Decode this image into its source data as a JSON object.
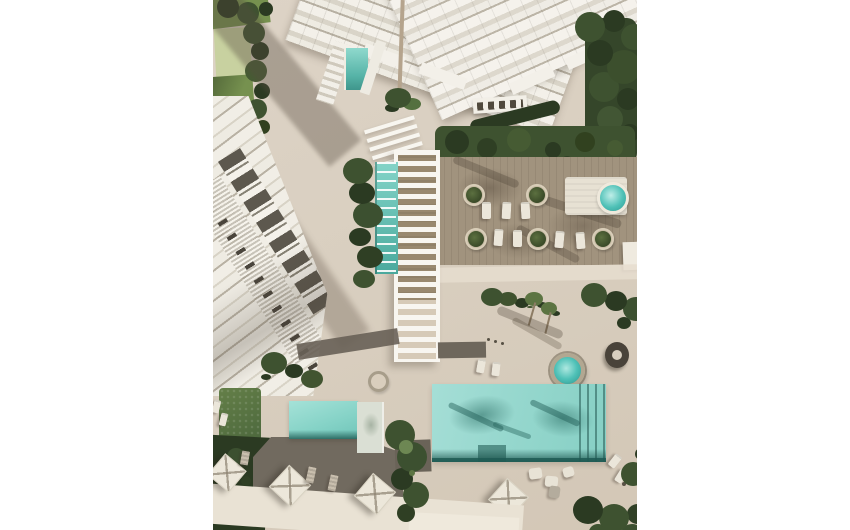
{
  "meta": {
    "type": "architectural-aerial-render",
    "description": "Top-down 3D architectural rendering of a beachfront residential complex: white apartment tower, diagonal row of townhouses, pergola walkway, lap pool, wooden sun deck with palm planters, two round spas, a large main pool and a smaller pool with umbrellas and sun loungers.",
    "canvas": {
      "width": 850,
      "height": 530
    },
    "content_area": {
      "left": 213,
      "width": 424,
      "height": 530
    }
  },
  "palette": {
    "ground": "#d9cfc0",
    "ground-light": "#e6ddcf",
    "ground-dark": "#cfc3b1",
    "path": "#e9e2d4",
    "tower-white": "#f3f0e9",
    "tower-stripe": "#d9d4c8",
    "tower-line": "#b7b0a2",
    "bld-white": "#f1eee6",
    "bld-dark": "#5d584e",
    "wood": "#a1937e",
    "deck-gray": "#716a5f",
    "walkway": "#6e675c",
    "pergola-white": "#f8f6f0",
    "pergola-wood": "#99896f",
    "pool-light": "#a5ded6",
    "pool-mid": "#86cfc4",
    "pool-dark": "#1f5a54",
    "pool-shadow": "#26685f",
    "lap-pool": "#83d4c8",
    "spa": "#4fc1b7",
    "lawn": "#76914f",
    "lawn-pale": "#c8d1a0",
    "tree": "#3e5230",
    "tree-dark": "#2b3a22",
    "tree-light": "#5c7442",
    "hedge": "#55713d",
    "umbrella": "#ece7da",
    "lounger": "#ebe6da",
    "tan": "#c9bfae",
    "shadow": "rgba(88,76,62,0.38)"
  },
  "scene": {
    "elements": [
      {
        "name": "white-margin-left",
        "desc": "blank white border left of render"
      },
      {
        "name": "white-margin-right",
        "desc": "blank white border right of render"
      },
      {
        "name": "tower-building",
        "desc": "white high-rise with stepped balconies, viewed from above at corner"
      },
      {
        "name": "tower-lap-pool",
        "desc": "small teal pool embedded in tower terraces"
      },
      {
        "name": "townhouse-row",
        "desc": "diagonal row of white townhouses with dark balcony recesses"
      },
      {
        "name": "pergola-walkway",
        "desc": "white slatted pergola over wooden boardwalk"
      },
      {
        "name": "lane-pool",
        "desc": "narrow lap pool with white lane steps beside pergola"
      },
      {
        "name": "wood-deck",
        "desc": "timber sun deck with circular palm planters and loungers"
      },
      {
        "name": "round-spa-upper",
        "desc": "round teal spa on white platform at deck right"
      },
      {
        "name": "round-spa-lower",
        "desc": "round teal spa near main pool"
      },
      {
        "name": "main-pool",
        "desc": "large teal pool with palm shadows and lane markers"
      },
      {
        "name": "small-pool",
        "desc": "smaller teal pool with gray deck, umbrellas and loungers"
      },
      {
        "name": "gardens",
        "desc": "dark green trees, hedges and lawns around the plaza"
      },
      {
        "name": "ground-plaza",
        "desc": "warm beige paved plaza with long diagonal shadows"
      }
    ]
  }
}
